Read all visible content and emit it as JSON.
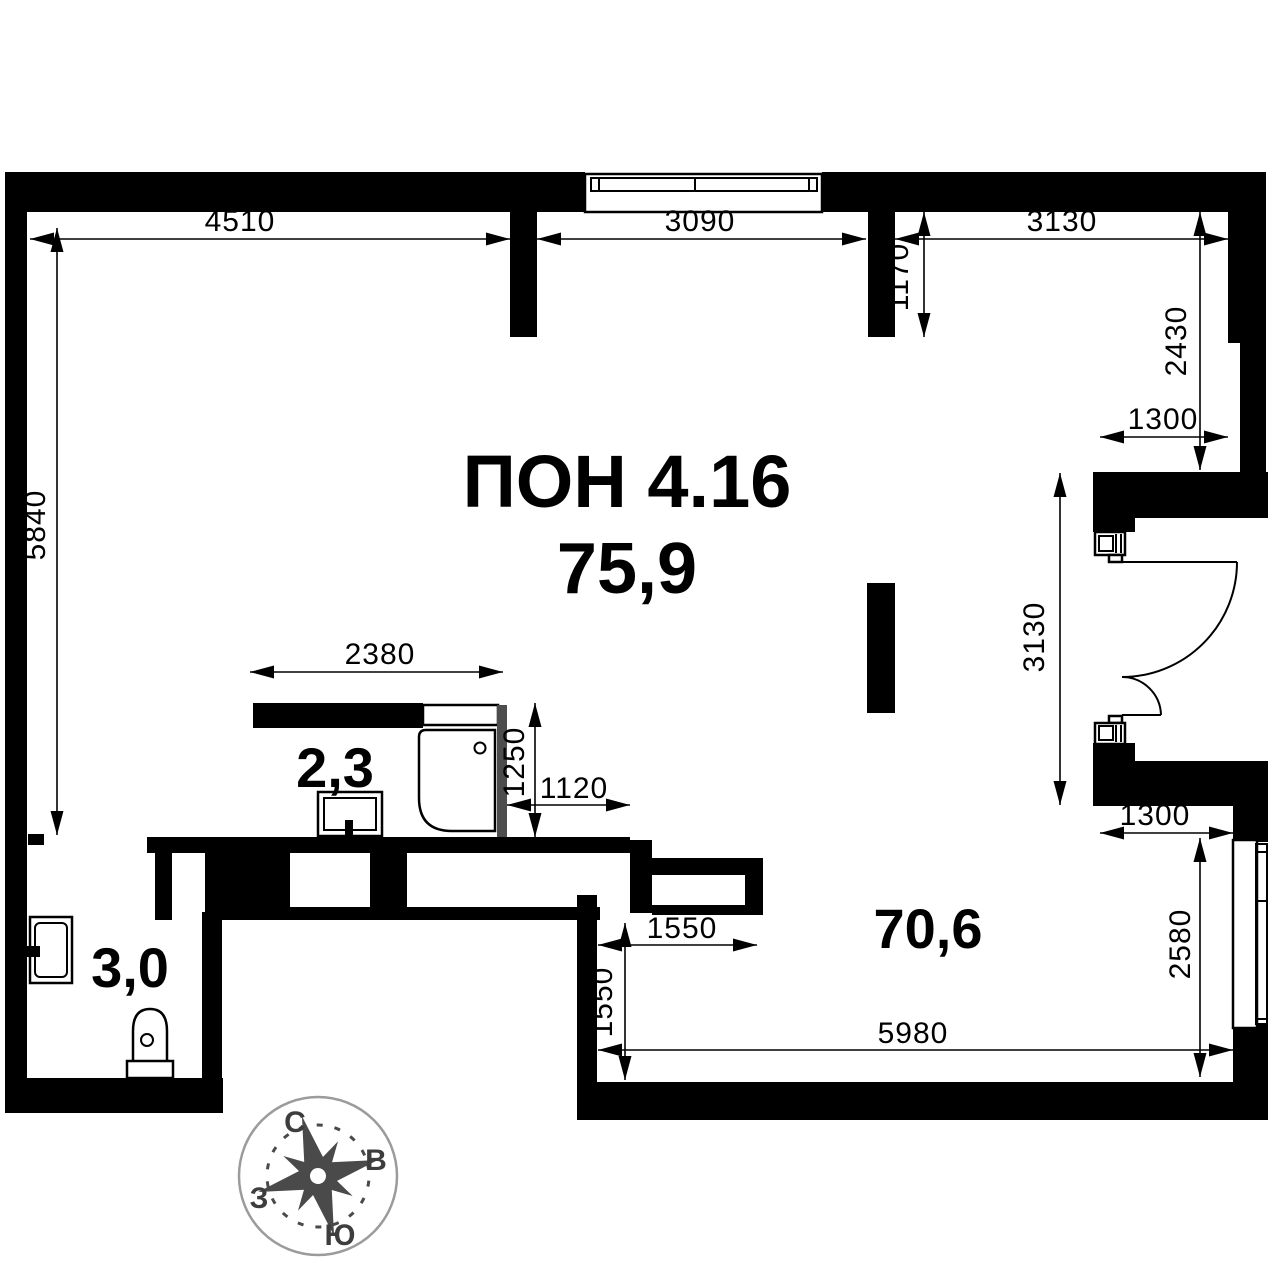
{
  "unit": {
    "code": "ПОН 4.16",
    "total_area": "75,9"
  },
  "rooms": {
    "main_area": "70,6",
    "bathroom_area": "2,3",
    "wc_area": "3,0"
  },
  "dimensions_mm": {
    "top_left_width": "4510",
    "top_window_width": "3090",
    "top_right_width": "3130",
    "niche_depth": "1170",
    "right_upper_height": "2430",
    "right_upper_opening": "1300",
    "door_wall_height": "3130",
    "right_lower_opening": "1300",
    "right_window_height": "2580",
    "bottom_width": "5980",
    "ledge_width": "1550",
    "ledge_height": "1550",
    "shower_to_wall": "1120",
    "shower_depth": "1250",
    "bath_counter_width": "2380",
    "left_height": "5840"
  },
  "compass": {
    "north_label": "С",
    "east_label": "В",
    "south_label": "Ю",
    "west_label": "З"
  },
  "colors": {
    "walls": "#000000",
    "background": "#ffffff",
    "compass_star": "#4a4a4a",
    "compass_ring": "#9b9b9b",
    "shower_screen": "#4d4d4d"
  }
}
